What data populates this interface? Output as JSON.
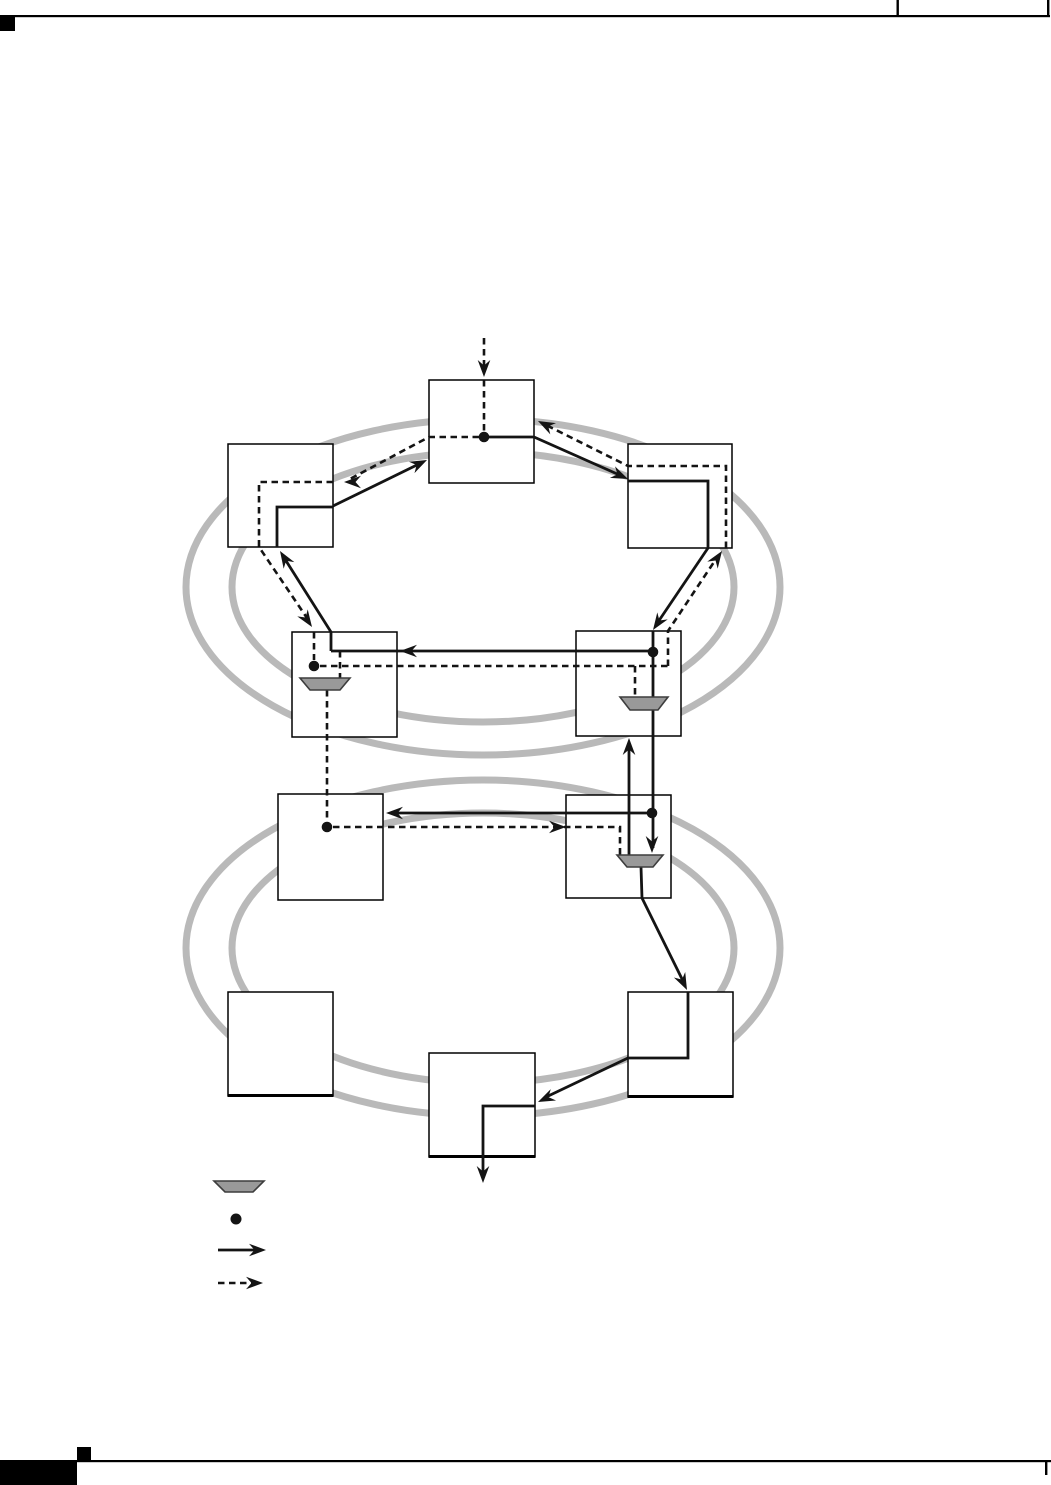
{
  "page": {
    "kind": "document-figure-page",
    "visible_text_items": []
  },
  "colors": {
    "background": "#ffffff",
    "ring": "#b9b9b9",
    "line": "#141414",
    "node_fill": "#ffffff",
    "node_stroke": "#000000",
    "trapezoid_fill": "#999999",
    "trapezoid_stroke": "#3d3d3d",
    "frame": "#000000"
  },
  "diagram": {
    "type": "dual-ring-network-topology",
    "rings": [
      {
        "id": "upper-ring",
        "style": "double-ellipse"
      },
      {
        "id": "lower-ring",
        "style": "double-ellipse"
      }
    ],
    "node_count": 10,
    "nodes": [
      {
        "id": "top-node",
        "ring": "upper"
      },
      {
        "id": "upper-left-node",
        "ring": "upper"
      },
      {
        "id": "upper-right-node",
        "ring": "upper"
      },
      {
        "id": "middle-left-node",
        "ring": "upper"
      },
      {
        "id": "middle-right-node",
        "ring": "upper"
      },
      {
        "id": "lower-left-node",
        "ring": "lower"
      },
      {
        "id": "lower-right-node",
        "ring": "lower"
      },
      {
        "id": "bottom-left-node",
        "ring": "lower"
      },
      {
        "id": "bottom-right-node",
        "ring": "lower"
      },
      {
        "id": "bottom-center-node",
        "ring": "lower"
      }
    ],
    "symbols": {
      "junction_dot_count": 5,
      "trapezoid_count": 3,
      "flow_styles": [
        "solid",
        "dashed"
      ]
    },
    "legend": {
      "items": [
        {
          "symbol": "trapezoid-icon"
        },
        {
          "symbol": "junction-dot-icon"
        },
        {
          "symbol": "solid-arrow-icon"
        },
        {
          "symbol": "dashed-arrow-icon"
        }
      ]
    }
  }
}
